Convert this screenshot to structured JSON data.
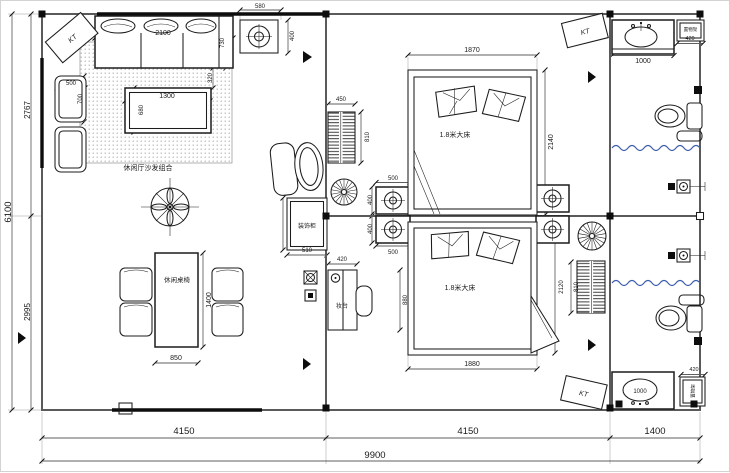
{
  "drawing": {
    "labels": {
      "kt": "KT",
      "sofa_group": "休闲厅沙发组合",
      "dining_set": "休闲桌椅",
      "bed_queen": "1.8米大床",
      "decor_cabinet": "装饰柜",
      "dresser": "妆台",
      "shelf": "置物架"
    },
    "dims": {
      "d9900": "9900",
      "d6100": "6100",
      "d4150": "4150",
      "d1400": "1400",
      "d2767": "2767",
      "d2995": "2995",
      "d2100": "2100",
      "d730": "730",
      "d320": "320",
      "d500": "500",
      "d700": "700",
      "d1300": "1300",
      "d680": "680",
      "d580": "580",
      "d400": "400",
      "d850": "850",
      "d450": "450",
      "d810": "810",
      "d510": "510",
      "d420": "420",
      "d880": "880",
      "d1870": "1870",
      "d2140": "2140",
      "d1880": "1880",
      "d2120": "2120",
      "d1000": "1000"
    },
    "colors": {
      "ink": "#1f1f1f",
      "wall": "#5a5a5a",
      "curtain_blue": "#3f5fae",
      "hatch_dot": "#adadad"
    }
  }
}
